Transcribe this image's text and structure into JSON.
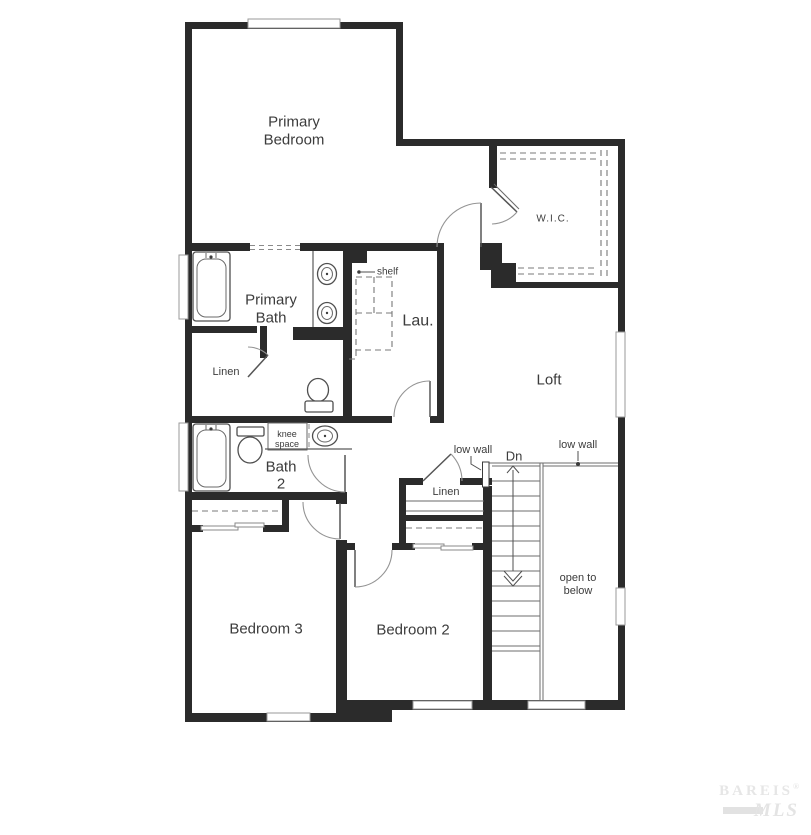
{
  "floorplan": {
    "rooms": {
      "primary_bedroom": {
        "line1": "Primary",
        "line2": "Bedroom"
      },
      "wic": {
        "label": "W.I.C."
      },
      "primary_bath": {
        "line1": "Primary",
        "line2": "Bath"
      },
      "linen_primary": {
        "label": "Linen"
      },
      "laundry": {
        "label": "Lau."
      },
      "loft": {
        "label": "Loft"
      },
      "bath2": {
        "line1": "Bath",
        "line2": "2"
      },
      "linen_hall": {
        "label": "Linen"
      },
      "bedroom3": {
        "label": "Bedroom 3"
      },
      "bedroom2": {
        "label": "Bedroom 2"
      }
    },
    "annotations": {
      "shelf": "shelf",
      "knee_space_line1": "knee",
      "knee_space_line2": "space",
      "low_wall_left": "low wall",
      "low_wall_right": "low wall",
      "down": "Dn",
      "open_below_line1": "open to",
      "open_below_line2": "below"
    },
    "watermark": {
      "brand": "BAREIS",
      "reg": "®",
      "mls": "MLS"
    },
    "colors": {
      "wall": "#2b2b2b",
      "thin_line": "#5a5a5a",
      "text": "#3c3c3c",
      "watermark": "#e6e6e6"
    }
  }
}
